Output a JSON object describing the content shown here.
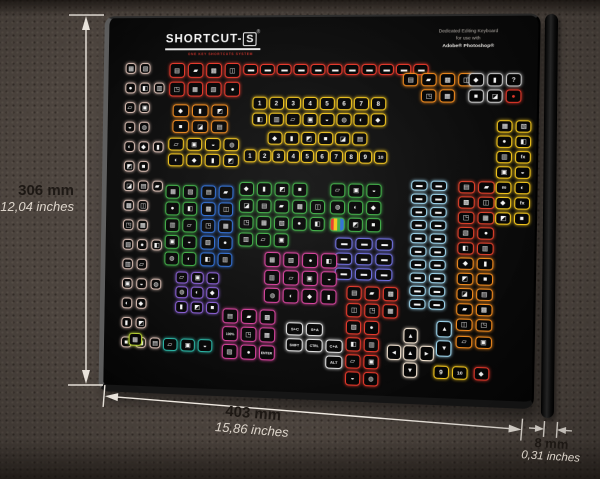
{
  "product": {
    "brand_prefix": "SHORTCUT-",
    "brand_suffix": "S",
    "registered": "®",
    "tagline": "ONE KEY SHORTCUTS SYSTEM",
    "description_lines": [
      "Dedicated Editing Keyboard",
      "for use with",
      "Adobe® Photoshop®"
    ]
  },
  "dimensions": {
    "height_mm": "306 mm",
    "height_inches": "12,04 inches",
    "width_mm": "403 mm",
    "width_inches": "15,86 inches",
    "depth_mm": "8 mm",
    "depth_inches": "0,31 inches"
  },
  "colors": {
    "background": "#4c443e",
    "keyboard_body": "#0a0a0a",
    "dimension_line": "#efe9e1",
    "red": "#e8392b",
    "orange": "#f08a1e",
    "yellow": "#f2c51d",
    "green": "#3fae46",
    "blue": "#2f6fd6",
    "cyan": "#9fd7ef",
    "magenta": "#d6419c",
    "purple": "#8a5fd6",
    "violet": "#6f6fe0",
    "teal": "#2ab5a5",
    "cream": "#f2e3d1",
    "pale": "#d9bdb2"
  },
  "keyboard": {
    "glyphs": [
      "▦",
      "◧",
      "▣",
      "◐",
      "◩",
      "▤",
      "◫",
      "▧",
      "▥",
      "◒",
      "◆",
      "■",
      "▰",
      "◳",
      "●",
      "▱",
      "◍",
      "▮",
      "◪",
      "▩"
    ],
    "clusters": [
      {
        "n": "left-strip",
        "c": "#d9bdb2",
        "x": 18,
        "y": 46,
        "kw": 11,
        "kh": 11,
        "g": 4,
        "vg": 9,
        "rows": [
          2,
          3,
          2,
          2,
          3,
          2,
          3,
          2,
          2,
          3,
          2,
          3,
          2,
          2,
          3
        ]
      },
      {
        "n": "red-block",
        "c": "#e8392b",
        "x": 64,
        "y": 46,
        "kw": 16,
        "kh": 15,
        "g": 3,
        "vg": 4,
        "rows": [
          4,
          4
        ]
      },
      {
        "n": "orange-block",
        "c": "#f08a1e",
        "x": 68,
        "y": 88,
        "kw": 17,
        "kh": 13,
        "g": 3,
        "vg": 3,
        "rows": [
          3,
          3
        ]
      },
      {
        "n": "yellow-file-block",
        "c": "#f2c51d",
        "x": 64,
        "y": 122,
        "kw": 16,
        "kh": 13,
        "g": 3,
        "vg": 3,
        "rows": [
          4,
          4
        ]
      },
      {
        "n": "menu-row",
        "c": "#e8392b",
        "x": 140,
        "y": 47,
        "kw": 15,
        "kh": 11,
        "g": 2,
        "glyph": "▬",
        "rows": [
          11
        ]
      },
      {
        "n": "number-block",
        "c": "#f2c51d",
        "x": 150,
        "y": 80,
        "kw": 15,
        "kh": 13,
        "g": 2,
        "vg": 3,
        "rows": [
          [
            "1",
            "2",
            "3",
            "4",
            "5",
            "6",
            "7",
            "8"
          ],
          8
        ]
      },
      {
        "n": "yellow-tool-row",
        "c": "#f2c51d",
        "x": 166,
        "y": 115,
        "kw": 15,
        "kh": 13,
        "g": 2,
        "rows": [
          6
        ]
      },
      {
        "n": "number-row-2",
        "c": "#f2c51d",
        "x": 142,
        "y": 133,
        "kw": 13,
        "kh": 13,
        "g": 1.5,
        "rows": [
          [
            "1",
            "2",
            "3",
            "4",
            "5",
            "6",
            "7",
            "8",
            "9",
            "10"
          ]
        ]
      },
      {
        "n": "green-grid",
        "c": "#3fae46",
        "x": 62,
        "y": 170,
        "kw": 15,
        "kh": 14,
        "g": 3,
        "vg": 3,
        "rows": [
          2,
          2,
          2,
          2,
          2
        ]
      },
      {
        "n": "blue-grid",
        "c": "#2f6fd6",
        "x": 99,
        "y": 170,
        "kw": 15,
        "kh": 14,
        "g": 3,
        "vg": 3,
        "rows": [
          2,
          2,
          2,
          2,
          2
        ]
      },
      {
        "n": "green-main",
        "c": "#3fae46",
        "x": 138,
        "y": 166,
        "kw": 15,
        "kh": 14,
        "g": 3,
        "vg": 3,
        "rows": [
          4,
          5,
          5,
          3
        ]
      },
      {
        "n": "green-right",
        "c": "#3fae46",
        "x": 230,
        "y": 166,
        "kw": 15,
        "kh": 14,
        "g": 3,
        "vg": 3,
        "rows": [
          3,
          3,
          [
            {
              "t": "rgb"
            },
            "",
            ""
          ]
        ]
      },
      {
        "n": "violet-block",
        "c": "#6f6fe0",
        "x": 236,
        "y": 220,
        "kw": 17,
        "kh": 12,
        "g": 3,
        "vg": 3,
        "glyph": "▬",
        "rows": [
          3,
          3,
          3
        ]
      },
      {
        "n": "red-column",
        "c": "#e8392b",
        "x": 248,
        "y": 268,
        "kw": 15,
        "kh": 14,
        "g": 3,
        "vg": 3,
        "rows": [
          3,
          3,
          2,
          2,
          2,
          2
        ]
      },
      {
        "n": "arrow-pad",
        "c": "#f2e3d1",
        "x": 289,
        "y": 308,
        "kw": 14,
        "kh": 15,
        "g": 2,
        "vg": 2,
        "rows": [
          [
            null,
            "▲",
            null
          ],
          [
            "◄",
            "▲",
            "►"
          ],
          [
            null,
            "▼",
            null
          ]
        ]
      },
      {
        "n": "cyan-columns",
        "c": "#9fd7ef",
        "x": 310,
        "y": 162,
        "kw": 16,
        "kh": 10,
        "g": 3,
        "vg": 3,
        "glyph": "▬",
        "rows": [
          2,
          2,
          2,
          2,
          2,
          2,
          2,
          2,
          2,
          2
        ]
      },
      {
        "n": "cyan-arrow-keys",
        "c": "#9fd7ef",
        "x": 337,
        "y": 300,
        "kw": 15,
        "kh": 16,
        "g": 3,
        "vg": 3,
        "rows": [
          [
            "▲"
          ],
          [
            "▼"
          ]
        ]
      },
      {
        "n": "right-red-column",
        "c": "#e0402a",
        "x": 356,
        "y": 162,
        "kw": 16,
        "kh": 12,
        "g": 3,
        "vg": 3,
        "rows": [
          2,
          2,
          2,
          2,
          2
        ]
      },
      {
        "n": "right-orange-column",
        "c": "#f08a1e",
        "x": 356,
        "y": 237,
        "kw": 16,
        "kh": 12,
        "g": 3,
        "vg": 3,
        "rows": [
          2,
          2,
          2,
          2,
          2
        ]
      },
      {
        "n": "right-orange-pair",
        "c": "#f08a1e",
        "x": 356,
        "y": 314,
        "kw": 16,
        "kh": 12,
        "g": 3,
        "vg": 3,
        "rows": [
          2
        ]
      },
      {
        "n": "yellow-fx-column",
        "c": "#f2c51d",
        "x": 392,
        "y": 102,
        "kw": 15,
        "kh": 12,
        "g": 3,
        "vg": 3,
        "rows": [
          2,
          2,
          [
            "",
            "fx"
          ],
          2,
          [
            "∞",
            ""
          ],
          [
            "",
            "fx"
          ],
          2
        ]
      },
      {
        "n": "top-orange-block",
        "c": "#f08a1e",
        "x": 300,
        "y": 56,
        "kw": 15,
        "kh": 13,
        "g": 3,
        "vg": 3,
        "rows": [
          4,
          [
            null,
            "",
            ""
          ]
        ]
      },
      {
        "n": "top-gray-block",
        "c": "#c8c8c8",
        "x": 364,
        "y": 56,
        "kw": 15,
        "kh": 13,
        "g": 3,
        "vg": 3,
        "rows": [
          [
            "",
            "",
            "?"
          ],
          [
            "",
            "",
            {
              "t": "●",
              "kc": "#e8392b"
            }
          ]
        ]
      },
      {
        "n": "purple-block",
        "c": "#8a5fd6",
        "x": 74,
        "y": 258,
        "kw": 13,
        "kh": 12,
        "g": 3,
        "vg": 3,
        "rows": [
          3,
          3,
          3
        ]
      },
      {
        "n": "magenta-upper",
        "c": "#d6419c",
        "x": 165,
        "y": 236,
        "kw": 16,
        "kh": 15,
        "g": 3,
        "vg": 3,
        "rows": [
          4,
          4,
          4
        ]
      },
      {
        "n": "magenta-lower",
        "c": "#d6419c",
        "x": 123,
        "y": 294,
        "kw": 16,
        "kh": 15,
        "g": 3,
        "vg": 3,
        "rows": [
          3,
          [
            "100%",
            "",
            ""
          ],
          [
            "",
            "",
            "ENTER"
          ]
        ]
      },
      {
        "n": "modifier-block",
        "c": "#e3e3e3",
        "x": 188,
        "y": 306,
        "kw": 17,
        "kh": 13,
        "g": 3,
        "vg": 3,
        "rows": [
          [
            "S+C",
            "S+A",
            null
          ],
          [
            "SHIFT",
            "CTRL",
            "C+A"
          ],
          [
            null,
            null,
            "ALT"
          ]
        ]
      },
      {
        "n": "teal-block",
        "c": "#2ab5a5",
        "x": 62,
        "y": 326,
        "kw": 15,
        "kh": 13,
        "g": 3,
        "vg": 3,
        "rows": [
          3
        ]
      },
      {
        "n": "lime-key",
        "c": "#b8d432",
        "x": 26,
        "y": 322,
        "kw": 14,
        "kh": 13,
        "g": 3,
        "vg": 3,
        "rows": [
          1
        ]
      },
      {
        "n": "bottom-yellow-keys",
        "c": "#f2c51d",
        "x": 335,
        "y": 344,
        "kw": 15,
        "kh": 13,
        "g": 3,
        "vg": 3,
        "rows": [
          [
            "9",
            "10"
          ]
        ]
      },
      {
        "n": "bottom-red-key",
        "c": "#e8392b",
        "x": 374,
        "y": 344,
        "kw": 15,
        "kh": 13,
        "g": 3,
        "vg": 3,
        "rows": [
          1
        ]
      }
    ]
  }
}
